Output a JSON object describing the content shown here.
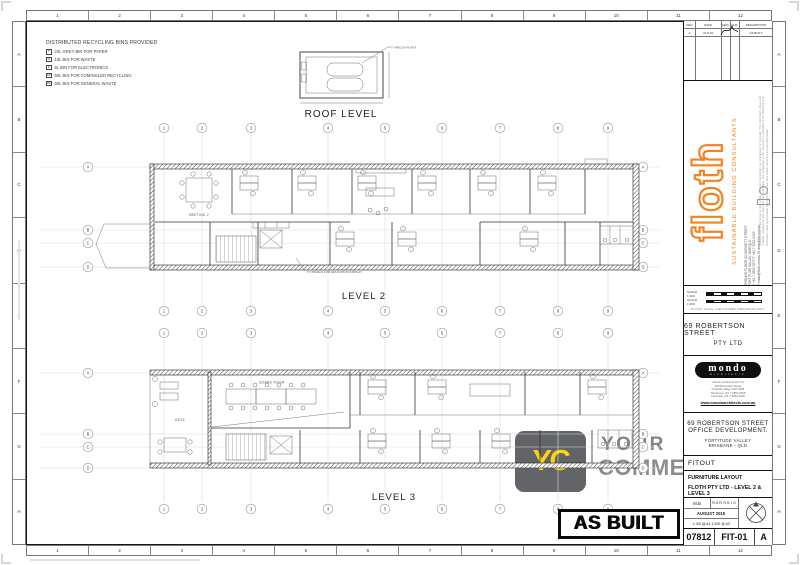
{
  "sheet": {
    "ruler_numbers": [
      "1",
      "2",
      "3",
      "4",
      "5",
      "6",
      "7",
      "8",
      "9",
      "10",
      "11",
      "12"
    ],
    "ruler_letters": [
      "A",
      "B",
      "C",
      "D",
      "E",
      "F",
      "G",
      "H"
    ]
  },
  "legend": {
    "title": "DISTRIBUTED RECYCLING BINS PROVIDED",
    "items": [
      {
        "symbol": "P",
        "label": "20L GREY BIN FOR PAPER"
      },
      {
        "symbol": "W",
        "label": "10L BIN FOR WASTE"
      },
      {
        "symbol": "E",
        "label": "6L BIN FOR ELECTRONICS"
      },
      {
        "symbol": "CR",
        "label": "60L BIN FOR COMINGLED RECYCLING"
      },
      {
        "symbol": "GW",
        "label": "60L BIN FOR GENERAL WASTE"
      }
    ]
  },
  "plans": {
    "grid_columns": [
      "1",
      "2",
      "3",
      "4",
      "5",
      "6",
      "7",
      "8",
      "9"
    ],
    "grid_rows": [
      "A",
      "B",
      "C",
      "D"
    ],
    "roof": {
      "label": "ROOF LEVEL",
      "annotation": "AIRCON PLANT"
    },
    "level2": {
      "label": "LEVEL 2",
      "meeting_room": "MEETING 2",
      "annotation": "TV PANELS FOR EDUCATION DISPLAY"
    },
    "level3": {
      "label": "LEVEL 3",
      "board_room": "BOARD ROOM",
      "deck": "DECK"
    }
  },
  "watermark": {
    "monogram": "YC",
    "line1": "YOUR",
    "line2": "COMMERCIAL"
  },
  "stamp": "AS BUILT",
  "title_block": {
    "revisions": {
      "headers": [
        "REV",
        "DATE",
        "DRN",
        "CHK",
        "DESCRIPTION"
      ],
      "row": {
        "rev": "A",
        "date": "31.8.15",
        "description": "AS BUILT"
      }
    },
    "floth": {
      "logo": "floth",
      "tagline": "SUSTAINABLE BUILDING CONSULTANTS",
      "contact_lines": [
        "GROUND FLOOR  40 DOGGETT STREET",
        "FORTITUDE VALLEY  4006 QLD",
        "T +61 7 3252 0977   F +61 7 3252 2499",
        "E email@floth.com.au   W www.floth.com.au"
      ],
      "disclaimer": "Reproduction of the whole or part of this document constitutes an infringement of copyright. The information, ideas and concepts contained in this document are confidential. The recipient(s) of this document is prohibited from disclosing such information, ideas and concepts to any person without prior written consent of the copyright holder."
    },
    "scale_bars": {
      "scale1": "SCALE 1:100",
      "scale2": "SCALE 1:200",
      "note": "DO NOT SCALE, USE FIGURED DIMENSIONS ONLY"
    },
    "client": {
      "line1": "69 ROBERTSON STREET",
      "line2": "PTY LTD"
    },
    "architect": {
      "logo": "mondo",
      "sub": "architects",
      "lines": [
        "Mondo Architects Pty Ltd",
        "469 Brunswick Street",
        "Fortitude Valley QLD 4006",
        "Telephone +61 7 3852 2525",
        "Facsimile +61 7 3852 2526"
      ],
      "website": "www.mondoarchitects.com.au"
    },
    "project": {
      "line1": "69 ROBERTSON STREET",
      "line2": "OFFICE DEVELOPMENT.",
      "line3": "FORTITUDE VALLEY",
      "line4": "BRISBANE - QLD"
    },
    "stage": "FITOUT",
    "drawing_title": {
      "line1": "FURNITURE LAYOUT",
      "line2": "FLOTH PTY LTD - LEVEL 2 & LEVEL 3"
    },
    "info": {
      "drawn": "M.B",
      "checked": "R.G.R, R.H, I.O",
      "date": "AUGUST 2015",
      "scales": "1:100 @ A1    1:200 @ A3"
    },
    "number": {
      "job": "07812",
      "sheet": "FIT-01",
      "revision": "A"
    }
  },
  "colors": {
    "accent_orange": "#F5821F",
    "watermark_yellow": "#FFD40A",
    "watermark_gray": "#6D6E71"
  }
}
